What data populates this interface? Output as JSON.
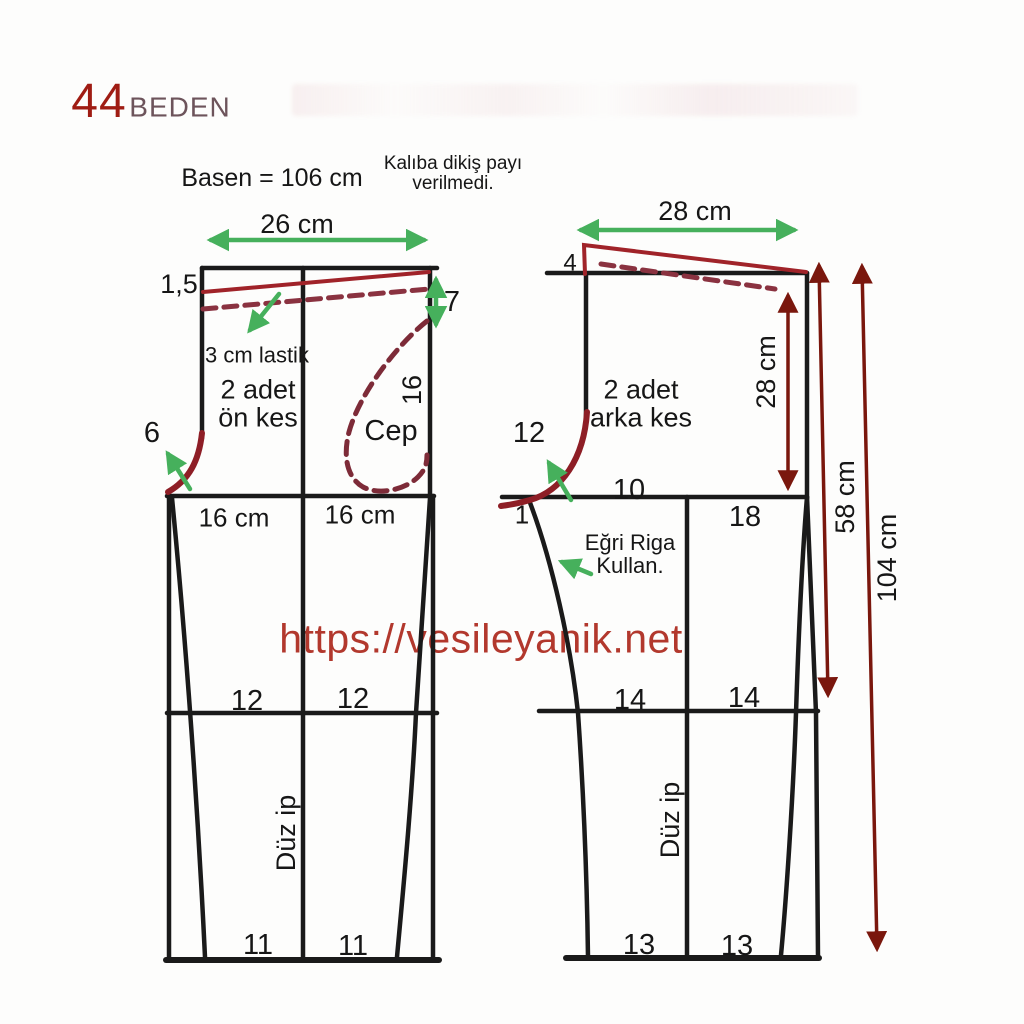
{
  "header": {
    "size_number": "44",
    "size_word": "BEDEN",
    "hip_note": "Basen = 106 cm",
    "seam_note_line1": "Kalıba dikiş payı",
    "seam_note_line2": "verilmedi."
  },
  "watermark": "https://vesileyanik.net",
  "front_piece": {
    "width": "26 cm",
    "waist_drop": "1,5",
    "side_depth": "7",
    "elastic_note": "3 cm lastik",
    "cut_line1": "2 adet",
    "cut_line2": "ön kes",
    "pocket_label": "Cep",
    "pocket_depth": "16",
    "crotch_extension": "6",
    "hip_left": "16 cm",
    "hip_right": "16 cm",
    "knee_left": "12",
    "knee_right": "12",
    "hem_left": "11",
    "hem_right": "11",
    "grain": "Düz ip"
  },
  "back_piece": {
    "width": "28 cm",
    "waist_rise": "4",
    "cut_line1": "2 adet",
    "cut_line2": "arka kes",
    "back_depth": "28 cm",
    "crotch_extension": "12",
    "hip_left": "10",
    "hip_right": "18",
    "crotch_point": "1",
    "ruler_note_line1": "Eğri Riga",
    "ruler_note_line2": "Kullan.",
    "knee_left": "14",
    "knee_right": "14",
    "hem_left": "13",
    "hem_right": "13",
    "grain": "Düz ip"
  },
  "measurements": {
    "to_knee": "58 cm",
    "full_length": "104 cm"
  },
  "colors": {
    "pattern_black": "#1a1a1a",
    "guide_green": "#46b05c",
    "seam_red": "#a02329",
    "dash_red": "#8a3240",
    "measure_dark_red": "#7a170d",
    "watermark_red": "#b2382d",
    "title_red": "#9f1c13",
    "title_maroon": "#6d545b"
  }
}
